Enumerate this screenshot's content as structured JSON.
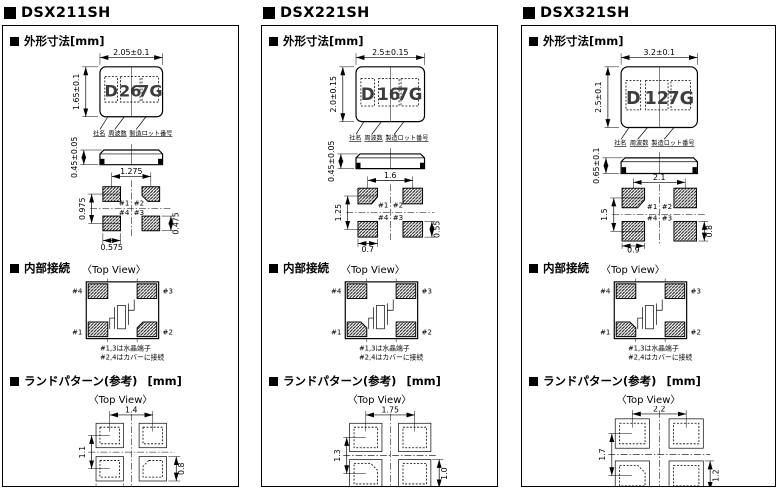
{
  "columns": [
    {
      "title": "DSX211SH",
      "outline_section": {
        "heading": "外形寸法[mm]",
        "top_view": {
          "width_dim": "2.05±0.1",
          "height_dim": "1.65±0.1",
          "marking": [
            "D",
            "26",
            "7G"
          ],
          "marking_labels": [
            "社名",
            "周波数",
            "製造ロット番号"
          ]
        },
        "side_view": {
          "height_dim": "0.45±0.05"
        },
        "bottom_view": {
          "pad_pitch_x": "1.275",
          "pad_pitch_y": "0.975",
          "pad_width": "0.575",
          "pad_height": "0.475",
          "pad_labels": [
            "#1",
            "#2",
            "#4",
            "#3"
          ]
        }
      },
      "connection_section": {
        "heading": "内部接続",
        "view_label": "〈Top View〉",
        "pins": {
          "top_left": "#4",
          "top_right": "#3",
          "bottom_left": "#1",
          "bottom_right": "#2"
        },
        "notes": [
          "#1,3は水晶端子",
          "#2,4はカバーに接続"
        ]
      },
      "land_section": {
        "heading": "ランドパターン(参考)",
        "unit": "[mm]",
        "view_label": "〈Top View〉",
        "pitch_x": "1.4",
        "pitch_y": "1.1",
        "pad_width": "0.9",
        "pad_height": "0.8"
      }
    },
    {
      "title": "DSX221SH",
      "outline_section": {
        "heading": "外形寸法[mm]",
        "top_view": {
          "width_dim": "2.5±0.15",
          "height_dim": "2.0±0.15",
          "marking": [
            "D",
            "16",
            "7G"
          ],
          "marking_labels": [
            "社名",
            "周波数",
            "製造ロット番号"
          ]
        },
        "side_view": {
          "height_dim": "0.45±0.05"
        },
        "bottom_view": {
          "pad_pitch_x": "1.6",
          "pad_pitch_y": "1.25",
          "pad_width": "0.7",
          "pad_height": "0.55",
          "pad_labels": [
            "#1",
            "#2",
            "#4",
            "#3"
          ]
        }
      },
      "connection_section": {
        "heading": "内部接続",
        "view_label": "〈Top View〉",
        "pins": {
          "top_left": "#4",
          "top_right": "#3",
          "bottom_left": "#1",
          "bottom_right": "#2"
        },
        "notes": [
          "#1,3は水晶端子",
          "#2,4はカバーに接続"
        ]
      },
      "land_section": {
        "heading": "ランドパターン(参考)",
        "unit": "[mm]",
        "view_label": "〈Top View〉",
        "pitch_x": "1.75",
        "pitch_y": "1.3",
        "pad_width": "1.15",
        "pad_height": "1.0"
      }
    },
    {
      "title": "DSX321SH",
      "outline_section": {
        "heading": "外形寸法[mm]",
        "top_view": {
          "width_dim": "3.2±0.1",
          "height_dim": "2.5±0.1",
          "marking": [
            "D",
            "12",
            "7G"
          ],
          "marking_labels": [
            "社名",
            "周波数",
            "製造ロット番号"
          ]
        },
        "side_view": {
          "height_dim": "0.65±0.1"
        },
        "bottom_view": {
          "pad_pitch_x": "2.1",
          "pad_pitch_y": "1.5",
          "pad_width": "0.9",
          "pad_height": "0.8",
          "pad_labels": [
            "#1",
            "#2",
            "#4",
            "#3"
          ]
        }
      },
      "connection_section": {
        "heading": "内部接続",
        "view_label": "〈Top View〉",
        "pins": {
          "top_left": "#4",
          "top_right": "#3",
          "bottom_left": "#1",
          "bottom_right": "#2"
        },
        "notes": [
          "#1,3は水晶端子",
          "#2,4はカバーに接続"
        ]
      },
      "land_section": {
        "heading": "ランドパターン(参考)",
        "unit": "[mm]",
        "view_label": "〈Top View〉",
        "pitch_x": "2.2",
        "pitch_y": "1.7",
        "pad_width": "1.4",
        "pad_height": "1.2"
      }
    }
  ]
}
